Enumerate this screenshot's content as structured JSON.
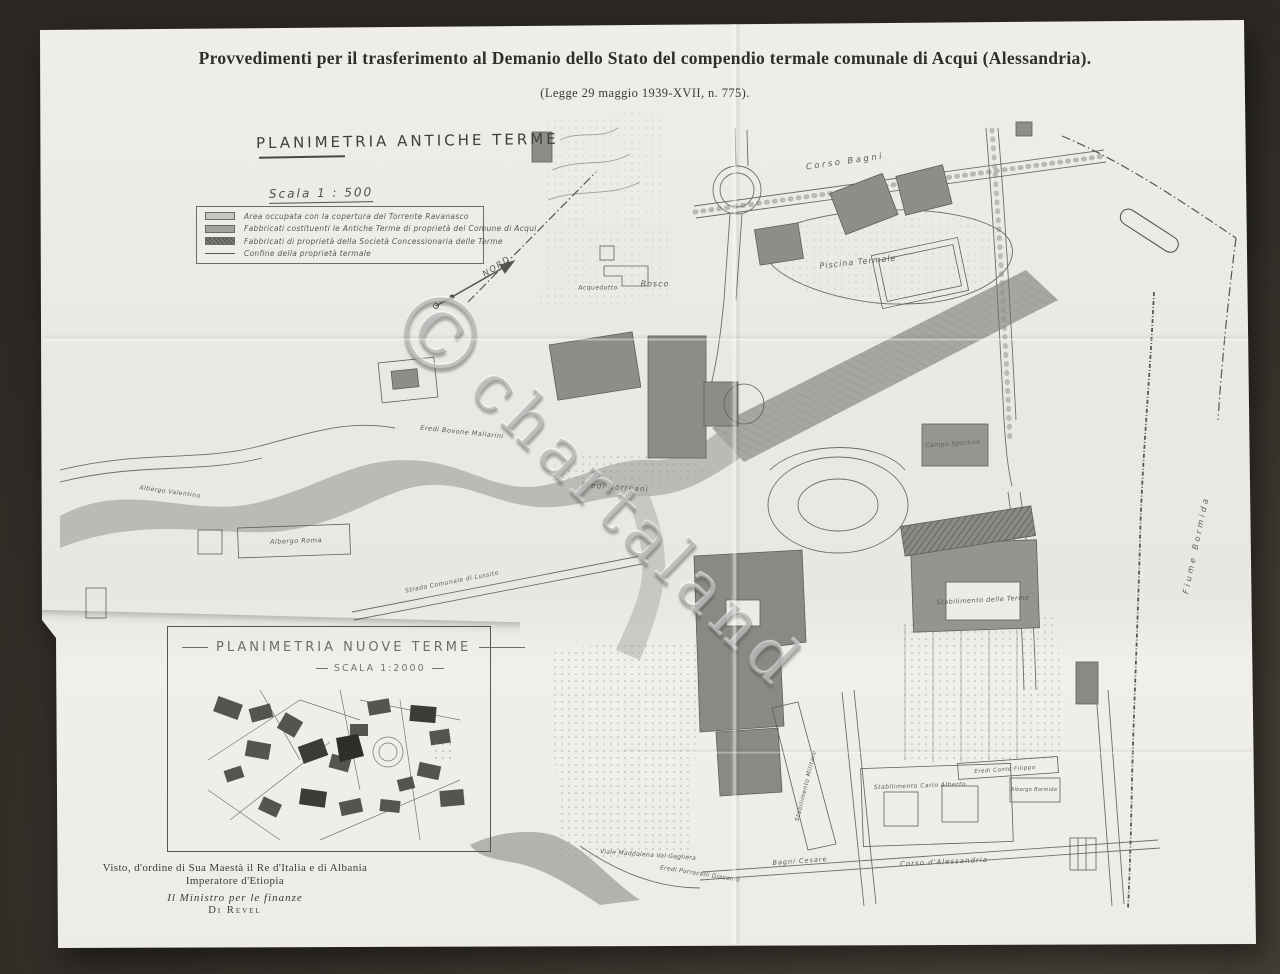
{
  "document": {
    "title": "Provvedimenti per il trasferimento al Demanio dello Stato del compendio termale comunale di Acqui (Alessandria).",
    "law_reference": "(Legge 29 maggio 1939-XVII, n. 775)."
  },
  "main_map": {
    "heading": "PLANIMETRIA ANTICHE TERME",
    "scale_label": "Scala 1 : 500",
    "legend": [
      {
        "label": "Area occupata con la copertura del Torrente Ravanasco",
        "swatch_type": "area-light",
        "color": "#c6c5c0"
      },
      {
        "label": "Fabbricati costituenti le Antiche Terme di proprietà del Comune di Acqui",
        "swatch_type": "area-mid",
        "color": "#a3a29d"
      },
      {
        "label": "Fabbricati di proprietà della Società Concessionaria delle Terme",
        "swatch_type": "area-dark-hatch",
        "color": "#7c7b76"
      },
      {
        "label": "Confine della proprietà termale",
        "swatch_type": "line",
        "color": "#55544f"
      }
    ],
    "labels": [
      {
        "text": "NORD",
        "x": 497,
        "y": 267,
        "rot": -33,
        "size": 8.5,
        "spacing": 1.5
      },
      {
        "text": "Corso Bagni",
        "x": 845,
        "y": 162,
        "rot": -8,
        "size": 8.5,
        "spacing": 2.5
      },
      {
        "text": "Piscina Termale",
        "x": 858,
        "y": 262,
        "rot": -6,
        "size": 8,
        "spacing": 1
      },
      {
        "text": "Bosco",
        "x": 655,
        "y": 284,
        "rot": 0,
        "size": 8,
        "spacing": 1
      },
      {
        "text": "Acquedotto",
        "x": 598,
        "y": 288,
        "rot": 0,
        "size": 6,
        "spacing": 0.5
      },
      {
        "text": "Eredi Bovone Mallarini",
        "x": 462,
        "y": 432,
        "rot": 6,
        "size": 6.5,
        "spacing": 0.5
      },
      {
        "text": "Eredi Borreani",
        "x": 615,
        "y": 487,
        "rot": 4,
        "size": 7.5,
        "spacing": 1
      },
      {
        "text": "Albergo Valentino",
        "x": 170,
        "y": 492,
        "rot": 8,
        "size": 6,
        "spacing": 0.5
      },
      {
        "text": "Albergo Roma",
        "x": 296,
        "y": 541,
        "rot": -2,
        "size": 6.5,
        "spacing": 0.5
      },
      {
        "text": "Strada Comunale di Lussito",
        "x": 452,
        "y": 582,
        "rot": -11,
        "size": 6,
        "spacing": 0.5
      },
      {
        "text": "Fiume Bormida",
        "x": 1196,
        "y": 545,
        "rot": -78,
        "size": 8,
        "spacing": 3
      },
      {
        "text": "Campo Sportivo",
        "x": 953,
        "y": 444,
        "rot": -4,
        "size": 6,
        "spacing": 0.5
      },
      {
        "text": "Stabilimento delle Terme",
        "x": 983,
        "y": 600,
        "rot": -3,
        "size": 6.5,
        "spacing": 0.5
      },
      {
        "text": "Stabilimento Militare",
        "x": 806,
        "y": 786,
        "rot": -76,
        "size": 6,
        "spacing": 0.5
      },
      {
        "text": "Stabilimento Carlo Alberto",
        "x": 920,
        "y": 786,
        "rot": -2,
        "size": 6,
        "spacing": 0.5
      },
      {
        "text": "Eredi Conte Filippo",
        "x": 1005,
        "y": 770,
        "rot": -4,
        "size": 5.5,
        "spacing": 0.5
      },
      {
        "text": "Albergo Bormida",
        "x": 1034,
        "y": 790,
        "rot": 0,
        "size": 5,
        "spacing": 0.3
      },
      {
        "text": "Corso d'Alessandria",
        "x": 944,
        "y": 862,
        "rot": -3,
        "size": 7,
        "spacing": 1
      },
      {
        "text": "Bagni Cesare",
        "x": 800,
        "y": 861,
        "rot": -4,
        "size": 6.5,
        "spacing": 1
      },
      {
        "text": "Viale Maddalena Val Gagliera",
        "x": 648,
        "y": 855,
        "rot": 4,
        "size": 6,
        "spacing": 0.3
      },
      {
        "text": "Eredi Porracelli Giacomo",
        "x": 700,
        "y": 874,
        "rot": 9,
        "size": 6,
        "spacing": 0.3
      }
    ]
  },
  "inset_map": {
    "heading": "PLANIMETRIA NUOVE TERME",
    "scale_label": "SCALA 1:2000"
  },
  "approval": {
    "lines": [
      "Visto, d'ordine di Sua Maestà il Re d'Italia e di Albania",
      "Imperatore d'Etiopia",
      "Il Ministro per le finanze",
      "Di Revel"
    ]
  },
  "watermark": {
    "symbol": "©",
    "word": "chartaland"
  },
  "colors": {
    "background": "#38342d",
    "paper": "#edebe5",
    "ink": "#4a4944",
    "building_fill": "#8e8d88",
    "water_fill": "#b3b2ad"
  }
}
